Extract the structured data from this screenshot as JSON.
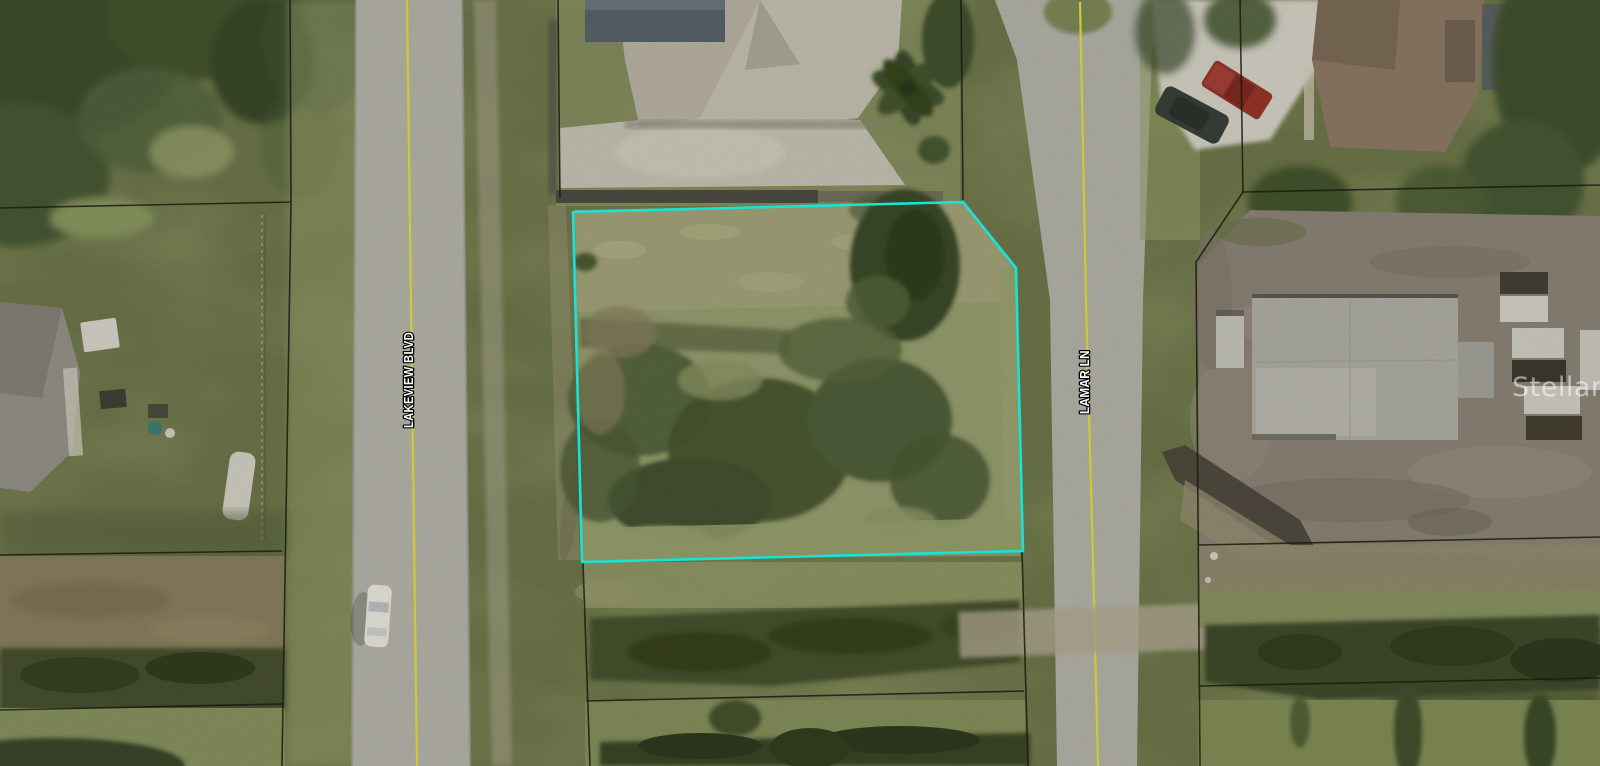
{
  "image": {
    "type": "aerial-satellite-photo",
    "description": "Overhead parcel map photo of a vacant residential lot outlined in cyan at the corner of two streets",
    "watermark": "Stellar MLS"
  },
  "streets": [
    {
      "name": "LAKEVIEW BLVD",
      "orientation": "vertical"
    },
    {
      "name": "LAMAR LN",
      "orientation": "vertical"
    }
  ],
  "lot_highlight": {
    "points": "573,212 963,202 1016,268 1023,551 582,562",
    "color": "#17E3D6"
  },
  "colors": {
    "road_centerline": "#E6E13A",
    "parcel_line": "#1A1A12",
    "label_fill": "#FFFFFF",
    "label_outline": "#000000"
  }
}
